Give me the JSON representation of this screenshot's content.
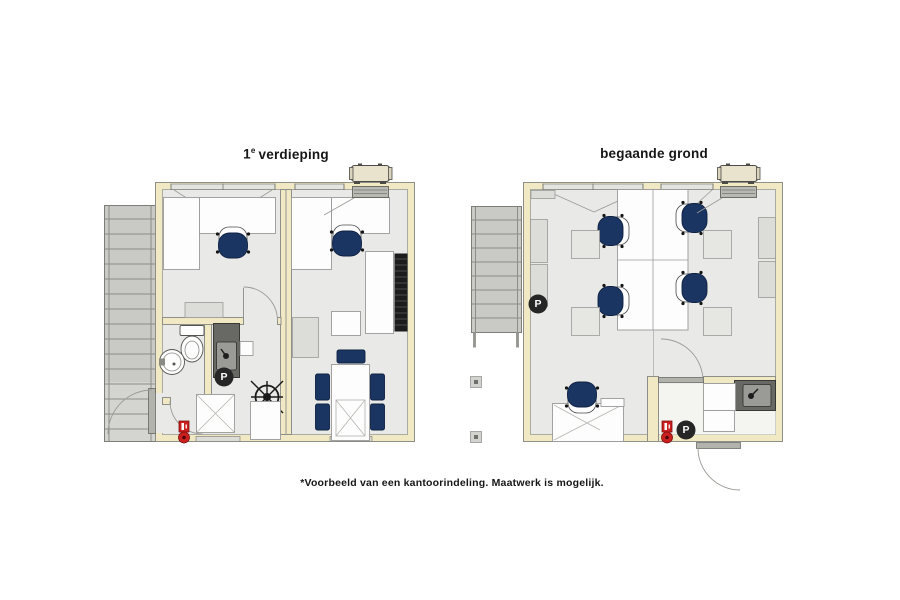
{
  "caption": "*Voorbeeld van een kantoorindeling. Maatwerk is mogelijk.",
  "plans": [
    {
      "name": "first-floor",
      "title": {
        "number": "1",
        "superscript": "e",
        "text": "verdieping"
      }
    },
    {
      "name": "ground-floor",
      "title": {
        "text": "begaande grond"
      }
    }
  ],
  "labels": {
    "printer_marker": "P"
  },
  "colors": {
    "background": "#ffffff",
    "wall_cream": "#f1e8c4",
    "floor_gray": "#e9e9e7",
    "desk_white": "#fdfdfd",
    "chair_navy": "#1b3563",
    "cabinet_gray": "#dcdcd8",
    "counter_dark": "#686865",
    "stair_gray": "#c9c9c5",
    "marker_black": "#262626",
    "fire_red": "#cc2020",
    "ac_beige": "#e9e2cd",
    "louver_black": "#1c1c1c",
    "text_black": "#161616"
  }
}
